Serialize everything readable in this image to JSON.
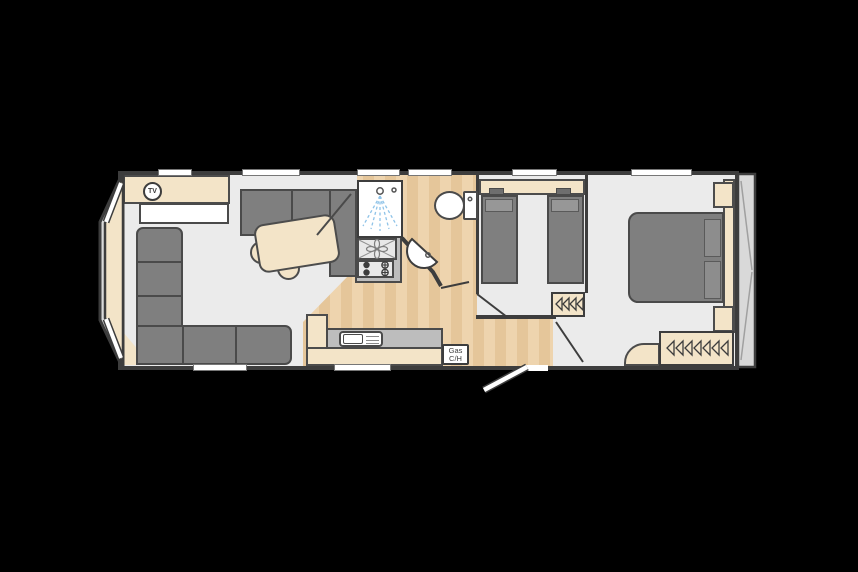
{
  "plan": {
    "tv_marker": {
      "label": "TV"
    },
    "gas_heater": {
      "line1": "Gas",
      "line2": "C/H"
    },
    "colors": {
      "bg": "#000000",
      "wall": "#3d3d3d",
      "floor": "#ebebeb",
      "wood_a": "#eed4ae",
      "wood_b": "#e5c69a",
      "cream": "#f3e4c8",
      "cream_line": "#4c4c4c",
      "furn": "#7f7f7f",
      "furn_line": "#4a4a4a",
      "pillow": "#979797",
      "counter": "#bdbdbd",
      "unit_light": "#e8e8e8",
      "spray": "#8fc3e8",
      "endcap": "#d9d9d9",
      "hair": "#a0a0a0"
    },
    "fixtures": [
      "tv-marker",
      "corner-sofa",
      "dinette-bench",
      "dining-table",
      "stools",
      "fan-oven",
      "gas-hob",
      "kitchen-sink",
      "gas-central-heating",
      "shower",
      "toilet",
      "basin",
      "twin-beds",
      "double-bed",
      "bedside-cabinets",
      "wardrobe-hangers",
      "entrance-door"
    ]
  }
}
